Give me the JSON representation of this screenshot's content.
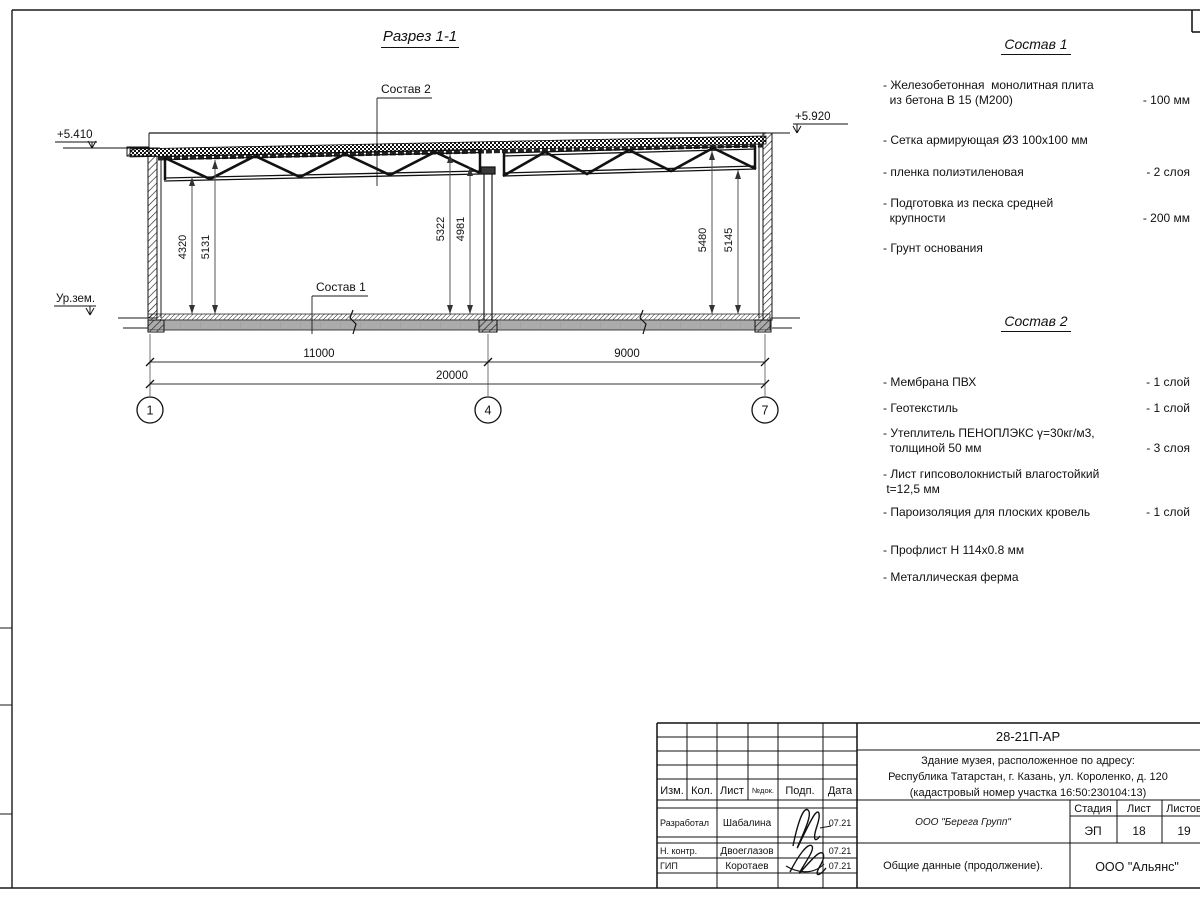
{
  "drawing": {
    "title": "Разрез 1-1",
    "leader_top": "Состав 2",
    "leader_floor": "Состав 1",
    "ground_label": "Ур.зем.",
    "level_left": "+5.410",
    "level_right": "+5.920",
    "dims": {
      "left": [
        "4320",
        "5131"
      ],
      "middle": [
        "5322",
        "4981"
      ],
      "right": [
        "5480",
        "5145"
      ],
      "span1": "11000",
      "span2": "9000",
      "total": "20000"
    },
    "axes": [
      "1",
      "4",
      "7"
    ]
  },
  "sostav1": {
    "title": "Состав 1",
    "items": [
      {
        "name": "- Железобетонная  монолитная плита\n  из бетона В 15 (М200)",
        "value": "- 100 мм"
      },
      {
        "name": "- Сетка армирующая Ø3 100х100 мм",
        "value": ""
      },
      {
        "name": "- пленка полиэтиленовая",
        "value": "- 2  слоя"
      },
      {
        "name": "- Подготовка из песка средней\n  крупности",
        "value": "- 200 мм"
      },
      {
        "name": "- Грунт основания",
        "value": ""
      }
    ]
  },
  "sostav2": {
    "title": "Состав 2",
    "items": [
      {
        "name": "- Мембрана ПВХ",
        "value": "- 1 слой"
      },
      {
        "name": "- Геотекстиль",
        "value": "- 1 слой"
      },
      {
        "name": "- Утеплитель ПЕНОПЛЭКС γ=30кг/м3,\n  толщиной 50 мм",
        "value": "- 3 слоя"
      },
      {
        "name": "- Лист гипсоволокнистый влагостойкий\n t=12,5 мм",
        "value": ""
      },
      {
        "name": "- Пароизоляция для плоских кровель",
        "value": "- 1 слой"
      },
      {
        "name": "- Профлист Н 114х0.8 мм",
        "value": ""
      },
      {
        "name": "- Металлическая ферма",
        "value": ""
      }
    ]
  },
  "titleblock": {
    "doc_number": "28-21П-АР",
    "project_line1": "Здание музея, расположенное по адресу:",
    "project_line2": "Республика Татарстан, г. Казань, ул. Короленко, д. 120",
    "project_line3": "(кадастровый номер участка 16:50:230104:13)",
    "contractor": "ООО \"Берега Групп\"",
    "sheet_title": "Общие данные (продолжение).",
    "company": "ООО \"Альянс\"",
    "stage_label": "Стадия",
    "stage_value": "ЭП",
    "sheet_label": "Лист",
    "sheet_value": "18",
    "sheets_label": "Листов",
    "sheets_value": "19",
    "header": {
      "izm": "Изм.",
      "kol": "Кол.",
      "list": "Лист",
      "ndok": "№док.",
      "podp": "Подп.",
      "data": "Дата"
    },
    "roles": [
      {
        "role": "Разработал",
        "name": "Шабалина",
        "date": "07.21"
      },
      {
        "role": "Н. контр.",
        "name": "Двоеглазов",
        "date": "07.21"
      },
      {
        "role": "ГИП",
        "name": "Коротаев",
        "date": "07.21"
      }
    ]
  },
  "colors": {
    "slab_gray": "#ababab",
    "line": "#1a1a1a",
    "dim": "#555555"
  }
}
